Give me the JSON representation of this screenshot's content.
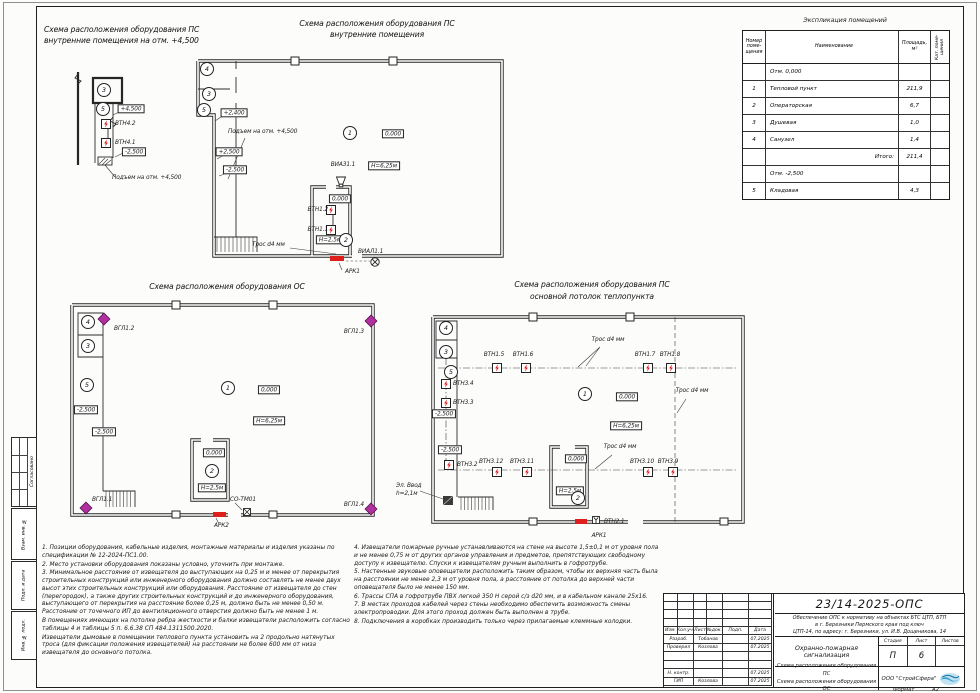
{
  "common": {
    "elev_zero": "0,000",
    "elev_p45": "+4,500",
    "elev_p25": "+2,500",
    "elev_p24": "+2,400",
    "elev_m25": "-2,500",
    "h_main": "Н=6,25м",
    "h_room": "Н=2,5м",
    "trose": "Трос d4 мм",
    "climb": "Подъем на отм. +4,500",
    "r1": "1",
    "r2": "2",
    "r3": "3",
    "r4": "4",
    "r5": "5"
  },
  "plans": {
    "a": {
      "t1": "Схема расположения оборудования ПС",
      "t2": "внутренние помещения на отм. +4,500",
      "vtn42": "ВТН4.2",
      "vtn41": "ВТН4.1"
    },
    "b": {
      "t1": "Схема расположения оборудования ПС",
      "t2": "внутренние помещения",
      "viaz": "ВИАЗ1.1",
      "vial": "ВИАЛ1.1",
      "vtn12": "ВТН1.2",
      "vtn11": "ВТН1.1",
      "ark1": "АРК1"
    },
    "c": {
      "t": "Схема расположения оборудования ОС",
      "g12": "ВГЛ1.2",
      "g13": "ВГЛ1.3",
      "g11": "ВГЛ1.1",
      "g14": "ВГЛ1.4",
      "sotm": "СО-ТМ01",
      "ark2": "АРК2"
    },
    "d": {
      "t1": "Схема расположения оборудования ПС",
      "t2": "основной потолок теплопункта",
      "vtn15": "ВТН1.5",
      "vtn16": "ВТН1.6",
      "vtn17": "ВТН1.7",
      "vtn18": "ВТН1.8",
      "vtn34": "ВТН3.4",
      "vtn33": "ВТН3.3",
      "vtn32": "ВТН3.2",
      "vtn312": "ВТН3.12",
      "vtn311": "ВТН3.11",
      "vtn310": "ВТН3.10",
      "vtn39": "ВТН3.9",
      "vtn21": "ВТН2.1",
      "ark1": "АРК1",
      "elv1": "Эл. Ввод",
      "elv2": "h=2,1м"
    }
  },
  "room_table": {
    "title": "Экспликация помещений",
    "h_num": "Номер поме- щения",
    "h_name": "Наименование",
    "h_area": "Площадь, м²",
    "h_cat": "Кат. поме- щения",
    "rows": [
      {
        "num": "",
        "name": "Отм. 0,000",
        "area": ""
      },
      {
        "num": "1",
        "name": "Тепловой пункт",
        "area": "211,9"
      },
      {
        "num": "2",
        "name": "Операторская",
        "area": "6,7"
      },
      {
        "num": "3",
        "name": "Душевая",
        "area": "1,0"
      },
      {
        "num": "4",
        "name": "Санузел",
        "area": "1,4"
      },
      {
        "num": "",
        "name": "Итого:",
        "area": "211,4"
      },
      {
        "num": "",
        "name": "Отм. -2,500",
        "area": ""
      },
      {
        "num": "5",
        "name": "Кладовая",
        "area": "4,3"
      }
    ]
  },
  "notes": {
    "left": [
      "1. Позиции оборудования, кабельные изделия, монтажные материалы и изделия указаны по спецификации № 12-2024-ПС1.00.",
      "2. Место установки оборудования показаны условно, уточнить при монтаже.",
      "3. Минимальное расстояние от извещателя до выступающих на 0,25 м и менее от перекрытия строительных конструкций или инженерного оборудования должно составлять не менее двух высот этих строительных конструкций или оборудования. Расстояние от извещателя до стен (перегородок), а также других строительных конструкций и до инженерного оборудования, выступающего от перекрытия на расстояние более 0,25 м, должно быть не менее 0,50 м. Расстояние от точечного ИП до вентиляционного отверстия должно быть не менее 1 м.",
      "В помещениях имеющих на потолке ребра жесткости и балки извещатели расположить согласно таблицы 4 и таблицы 5 п. 6.6.38 СП 484.1311500.2020.",
      "Извещатели дымовые в помещении теплового пункта установить на 2 продольно натянутых троса (для фиксации положения извещателей) на расстоянии не более 600 мм от низа извещателя до основного потолка."
    ],
    "right": [
      "4. Извещатели пожарные ручные устанавливаются на стене на высоте 1,5±0,1 м от уровня пола и не менее 0,75 м от других органов управления и предметов, препятствующих свободному доступу к извещателю. Спуски к извещателям ручным выполнить в гофротрубе.",
      "5. Настенные звуковые оповещатели расположить таким образом, чтобы их верхняя часть была на расстоянии не менее 2,3 м от уровня пола, а расстояние от потолка до верхней части оповещателя было не менее 150 мм.",
      "6. Трассы СПА в гофротрубе ПВХ легкой 350 Н серой с/з d20 мм, и в кабельном канале 25х16.",
      "7. В местах проходов кабелей через стены необходимо обеспечить возможность смены электропроводки. Для этого проход должен быть выполнен в трубе.",
      "8. Подключения в коробках производить только через прилагаемые клеммные колодки."
    ]
  },
  "title_block": {
    "doc_number": "23/14-2025-ОПС",
    "desc": [
      "Обеспечение ОПС к нормативу на объектах БТС ЦТП, БТП",
      "в г. Березники Пермского края под ключ",
      "ЦТП-14, по адресу: г. Березники, ул. И.В. Дощеникова, 14"
    ],
    "cols": [
      "Изм.",
      "Кол.уч.",
      "Лист",
      "№док.",
      "Подп.",
      "Дата"
    ],
    "rows": [
      {
        "role": "Разраб.",
        "name": "Тобанов",
        "date": "07.2025"
      },
      {
        "role": "Проверил",
        "name": "Козлова",
        "date": "07.2025"
      },
      {
        "role": "Н. контр.",
        "name": "",
        "date": "07.2025"
      },
      {
        "role": "ГИП",
        "name": "Козлова",
        "date": "07.2025"
      }
    ],
    "subject": "Охранно-пожарная сигнализация",
    "stage_headers": [
      "Стадия",
      "Лист",
      "Листов"
    ],
    "stage": "П",
    "sheet_num": "6",
    "sheets_total": "",
    "sheet_title1": "Схема расположения оборудования ПС",
    "sheet_title2": "Схема расположения оборудования ОС",
    "company": "ООО \"СтройСфера\""
  },
  "frame": {
    "side1": "Согласовано",
    "side2": "Взам. инв. №",
    "side3": "Подп. и дата",
    "side4": "Инв. № подл.",
    "format_label": "Формат",
    "format_value": "А2"
  }
}
